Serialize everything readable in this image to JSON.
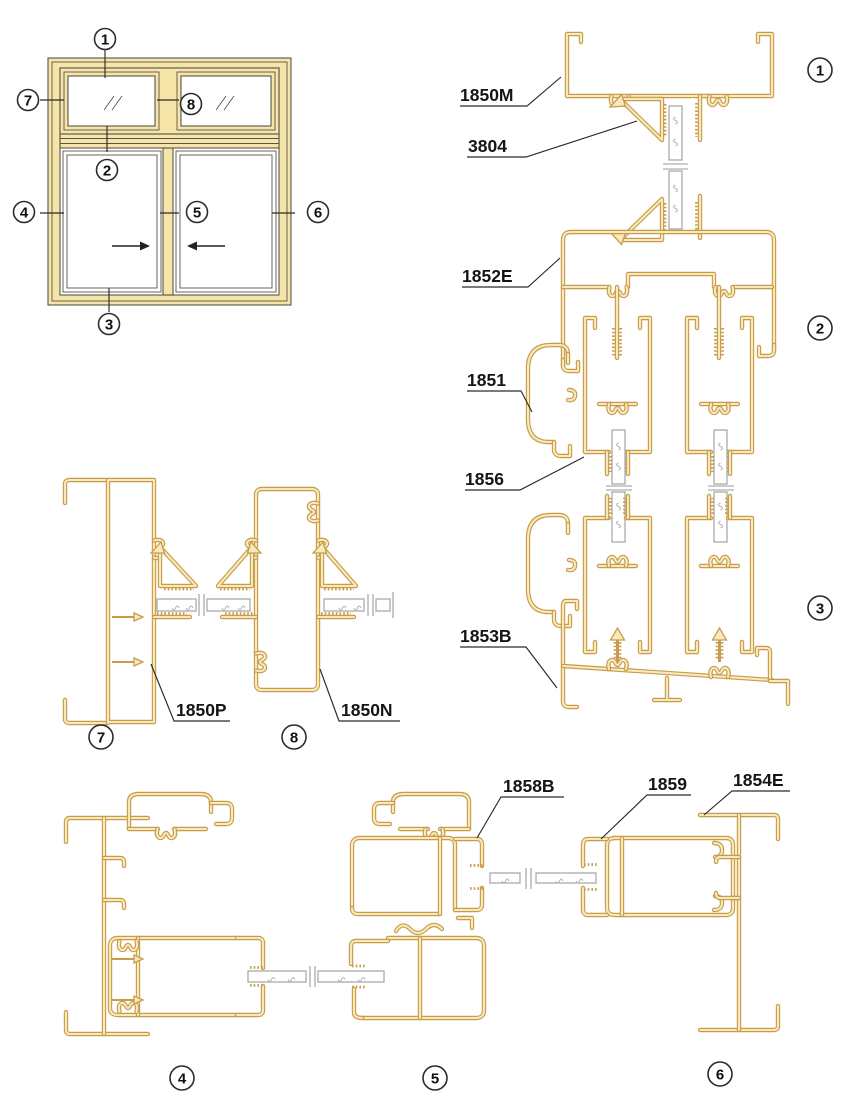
{
  "colors": {
    "gold": "#C89C4E",
    "cream": "#F7E9B9",
    "tan": "#F6E5A8",
    "ink": "#2B2B2B",
    "glass_gray": "#9B9B9B"
  },
  "part_labels": {
    "p1850M": "1850M",
    "p3804": "3804",
    "p1852E": "1852E",
    "p1851": "1851",
    "p1856": "1856",
    "p1853B": "1853B",
    "p1850P": "1850P",
    "p1850N": "1850N",
    "p1858B": "1858B",
    "p1859": "1859",
    "p1854E": "1854E"
  },
  "section_markers": {
    "s1": "1",
    "s2": "2",
    "s3": "3",
    "s4": "4",
    "s5": "5",
    "s6": "6",
    "s7": "7",
    "s8": "8"
  }
}
